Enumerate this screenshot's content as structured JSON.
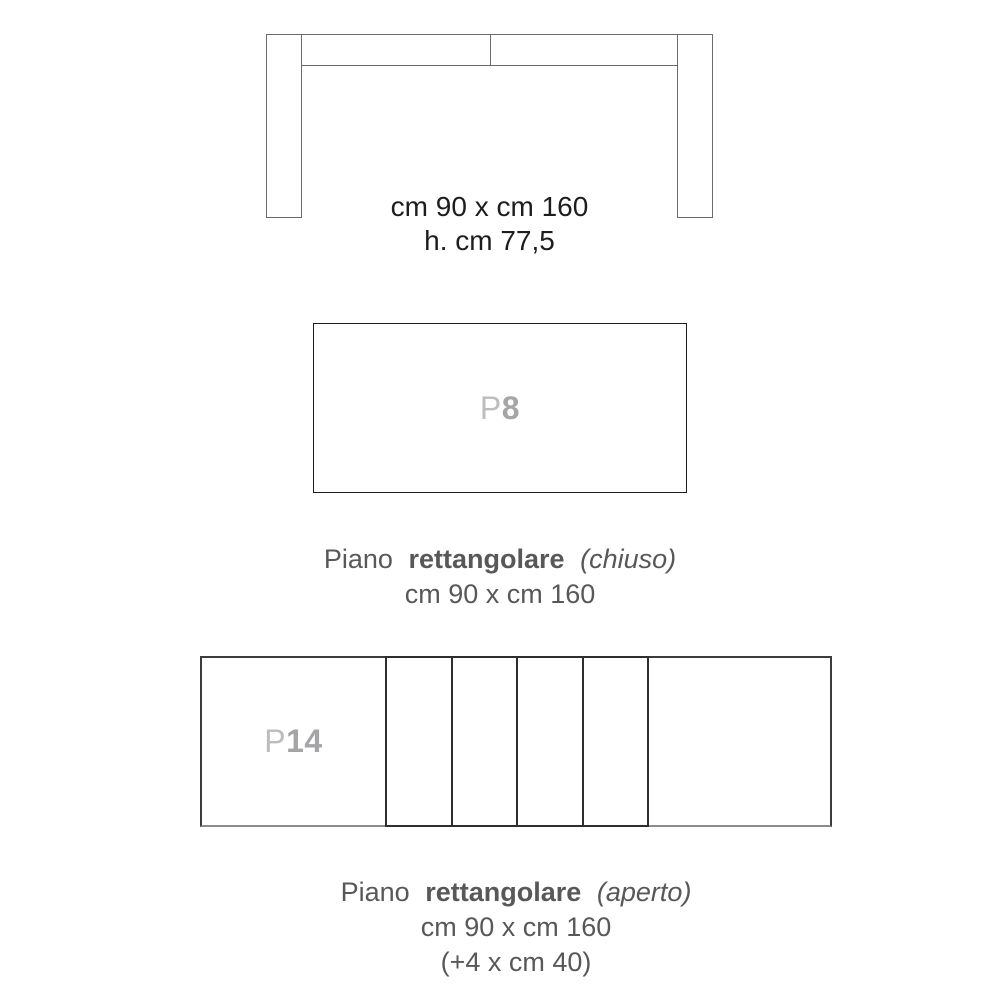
{
  "page": {
    "background": "#ffffff",
    "description": "Furniture dimension sheet for an extendable rectangular table"
  },
  "colors": {
    "drawing_line": "#6b6b6b",
    "closed_rect_border": "#1c1c1c",
    "open_rect_border": "#3c3c3c",
    "leaf_border": "#2e2e2e",
    "dimension_text": "#1d1d1b",
    "caption_text": "#58585a",
    "code_prefix_color": "#bdbdbd",
    "code_number_color": "#a5a5a7"
  },
  "elevation": {
    "dimensions": [
      "cm 90 x cm 160",
      "h. cm 77,5"
    ]
  },
  "closed_top": {
    "code_prefix": "P",
    "code_number": "8",
    "caption": {
      "word1": "Piano",
      "word2": "rettangolare",
      "word3": "(chiuso)"
    },
    "dimensions": "cm 90 x cm 160"
  },
  "open_top": {
    "code_prefix": "P",
    "code_number": "14",
    "leaf_count": 4,
    "caption": {
      "word1": "Piano",
      "word2": "rettangolare",
      "word3": "(aperto)"
    },
    "dimensions": "cm 90 x cm 160",
    "extension_note": "(+4 x cm 40)"
  }
}
